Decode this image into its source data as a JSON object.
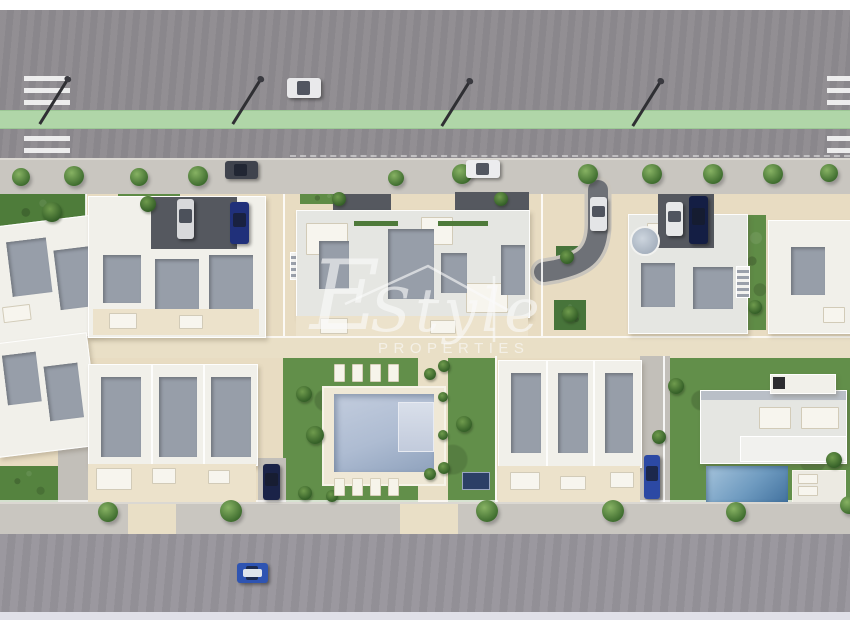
{
  "watermark": {
    "initial": "E",
    "script": "Style",
    "caps": "PROPERTIES"
  },
  "palette": {
    "road_top": "#8e8b90",
    "road_bottom": "#97949a",
    "bike_lane_green": "#b0d6a8",
    "sidewalk": "#c9c6c0",
    "development_ground": "#e8dcc2",
    "building_white": "#f1f0ea",
    "roof_shadow_gray": "#979ea9",
    "grass_green": "#5f8c46",
    "pool_blue": "#aebcd2",
    "villa_pool_blue": "#6f9bc0",
    "crosswalk_white": "#f2f2f2",
    "margin_white": "#ffffff"
  },
  "scene": {
    "trees": [
      [
        12,
        168,
        18
      ],
      [
        64,
        166,
        20
      ],
      [
        130,
        168,
        18
      ],
      [
        188,
        166,
        20
      ],
      [
        388,
        170,
        16
      ],
      [
        452,
        164,
        20
      ],
      [
        578,
        164,
        20
      ],
      [
        642,
        164,
        20
      ],
      [
        703,
        164,
        20
      ],
      [
        763,
        164,
        20
      ],
      [
        820,
        164,
        18
      ],
      [
        98,
        502,
        20
      ],
      [
        220,
        500,
        22
      ],
      [
        476,
        500,
        22
      ],
      [
        602,
        500,
        22
      ],
      [
        726,
        502,
        20
      ],
      [
        840,
        496,
        18
      ]
    ],
    "bushes": [
      [
        42,
        202,
        20
      ],
      [
        140,
        196,
        16
      ],
      [
        332,
        192,
        14
      ],
      [
        494,
        192,
        14
      ],
      [
        560,
        250,
        14
      ],
      [
        562,
        306,
        16
      ],
      [
        296,
        386,
        16
      ],
      [
        306,
        426,
        18
      ],
      [
        456,
        416,
        16
      ],
      [
        424,
        368,
        12
      ],
      [
        424,
        468,
        12
      ],
      [
        668,
        378,
        16
      ],
      [
        652,
        430,
        14
      ],
      [
        748,
        300,
        14
      ],
      [
        298,
        486,
        14
      ],
      [
        326,
        490,
        12
      ],
      [
        438,
        360,
        12
      ],
      [
        438,
        392,
        10
      ],
      [
        438,
        430,
        10
      ],
      [
        438,
        462,
        12
      ],
      [
        826,
        452,
        16
      ]
    ],
    "loungers": [
      [
        334,
        364
      ],
      [
        352,
        364
      ],
      [
        370,
        364
      ],
      [
        388,
        364
      ],
      [
        334,
        478
      ],
      [
        352,
        478
      ],
      [
        370,
        478
      ],
      [
        388,
        478
      ]
    ],
    "cars": [
      {
        "name": "white-car-driving-top-road",
        "x": 287,
        "y": 78,
        "w": 34,
        "h": 20,
        "body": "#e9e9eb"
      },
      {
        "name": "dark-car-parked-top-road",
        "x": 225,
        "y": 161,
        "w": 33,
        "h": 18,
        "body": "#3f434d"
      },
      {
        "name": "white-car-parked-top-road",
        "x": 466,
        "y": 160,
        "w": 34,
        "h": 18,
        "body": "#ececee"
      },
      {
        "name": "white-car-block2",
        "x": 177,
        "y": 199,
        "w": 17,
        "h": 40,
        "body": "#d8d9db"
      },
      {
        "name": "blue-car-block2",
        "x": 230,
        "y": 202,
        "w": 19,
        "h": 42,
        "body": "#20307a"
      },
      {
        "name": "white-car-curved-drive",
        "x": 590,
        "y": 197,
        "w": 17,
        "h": 34,
        "body": "#e4e5e7"
      },
      {
        "name": "white-car-block4",
        "x": 666,
        "y": 202,
        "w": 17,
        "h": 34,
        "body": "#e7e8e9"
      },
      {
        "name": "navy-car-block4",
        "x": 689,
        "y": 196,
        "w": 19,
        "h": 48,
        "body": "#141e44"
      },
      {
        "name": "navy-car-townhouse-row",
        "x": 263,
        "y": 464,
        "w": 17,
        "h": 36,
        "body": "#1a2348"
      },
      {
        "name": "blue-car-driveway",
        "x": 644,
        "y": 455,
        "w": 16,
        "h": 44,
        "body": "#2c49a4"
      },
      {
        "name": "blue-car-bottom-road",
        "x": 237,
        "y": 563,
        "w": 31,
        "h": 20,
        "body": "#2e54b2",
        "roof": "#dfe5ec"
      }
    ]
  }
}
